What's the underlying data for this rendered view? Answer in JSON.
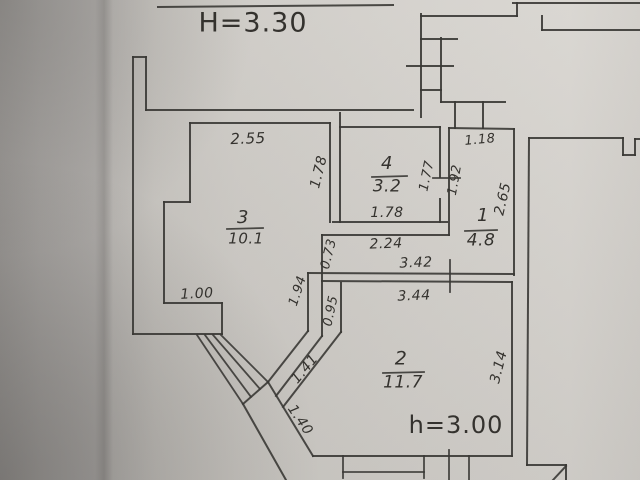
{
  "plan": {
    "heights": {
      "overall": "H=3.30",
      "room2": "h=3.00"
    },
    "rooms": [
      {
        "number": "3",
        "area": "10.1"
      },
      {
        "number": "4",
        "area": "3.2"
      },
      {
        "number": "1",
        "area": "4.8"
      },
      {
        "number": "2",
        "area": "11.7"
      }
    ],
    "dims": {
      "w255": "2.55",
      "r3_178": "1.78",
      "w100": "1.00",
      "r4_178": "1.78",
      "w224": "2.24",
      "r4_177": "1.77",
      "r1_192": "1.92",
      "w118": "1.18",
      "r1_265": "2.65",
      "w342": "3.42",
      "w344": "3.44",
      "w073": "0.73",
      "w194": "1.94",
      "w095": "0.95",
      "w141": "1.41",
      "w140": "1.40",
      "r2_314": "3.14"
    },
    "ink_color": "#3a3835",
    "paper_color": "#cecbc6"
  }
}
